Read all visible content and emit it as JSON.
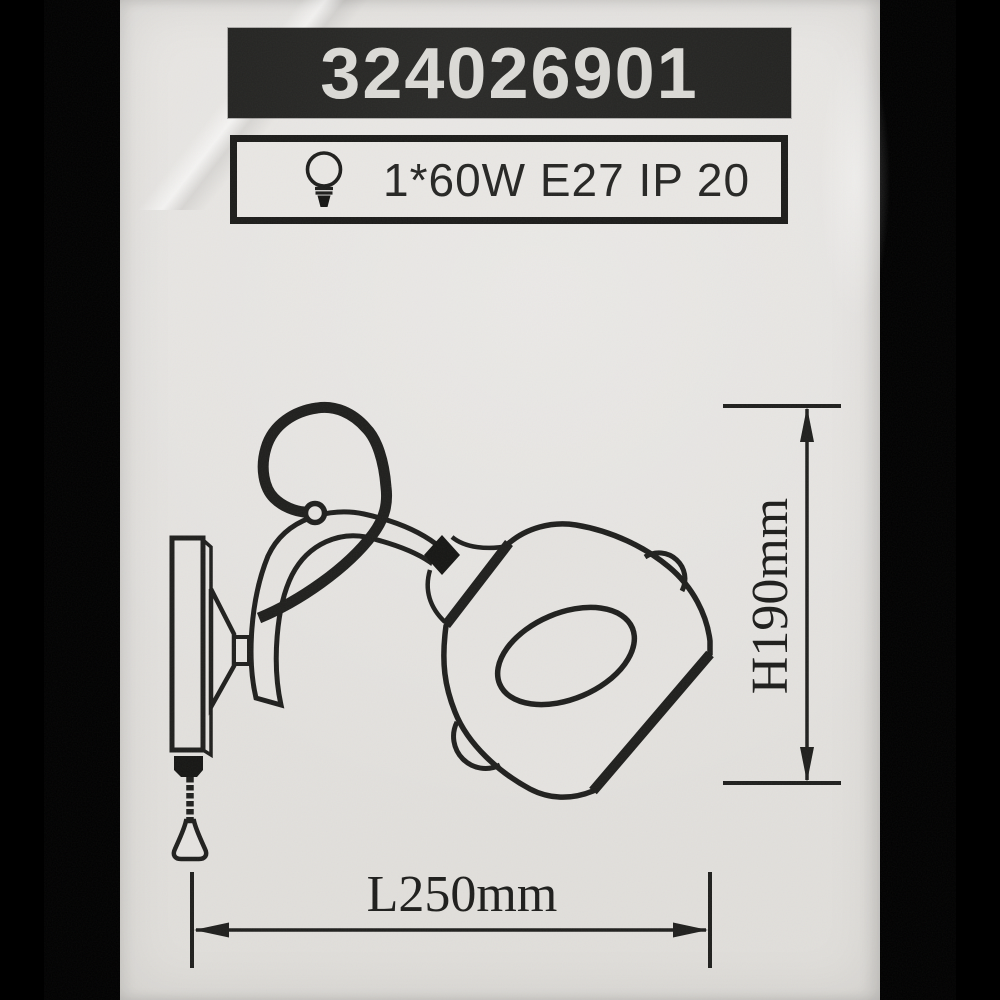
{
  "label": {
    "product_code": "324026901",
    "spec_text": "1*60W E27 IP 20",
    "bulb_icon": "light-bulb-icon"
  },
  "diagram": {
    "figure": "wall-sconce-line-drawing",
    "height_label": "H190mm",
    "length_label": "L250mm"
  },
  "colors": {
    "paper": "#e5e3e0",
    "ink": "#1f1f1d",
    "side_bars": "#000000",
    "code_box_bg": "#272725",
    "code_text": "#dbdad6"
  }
}
